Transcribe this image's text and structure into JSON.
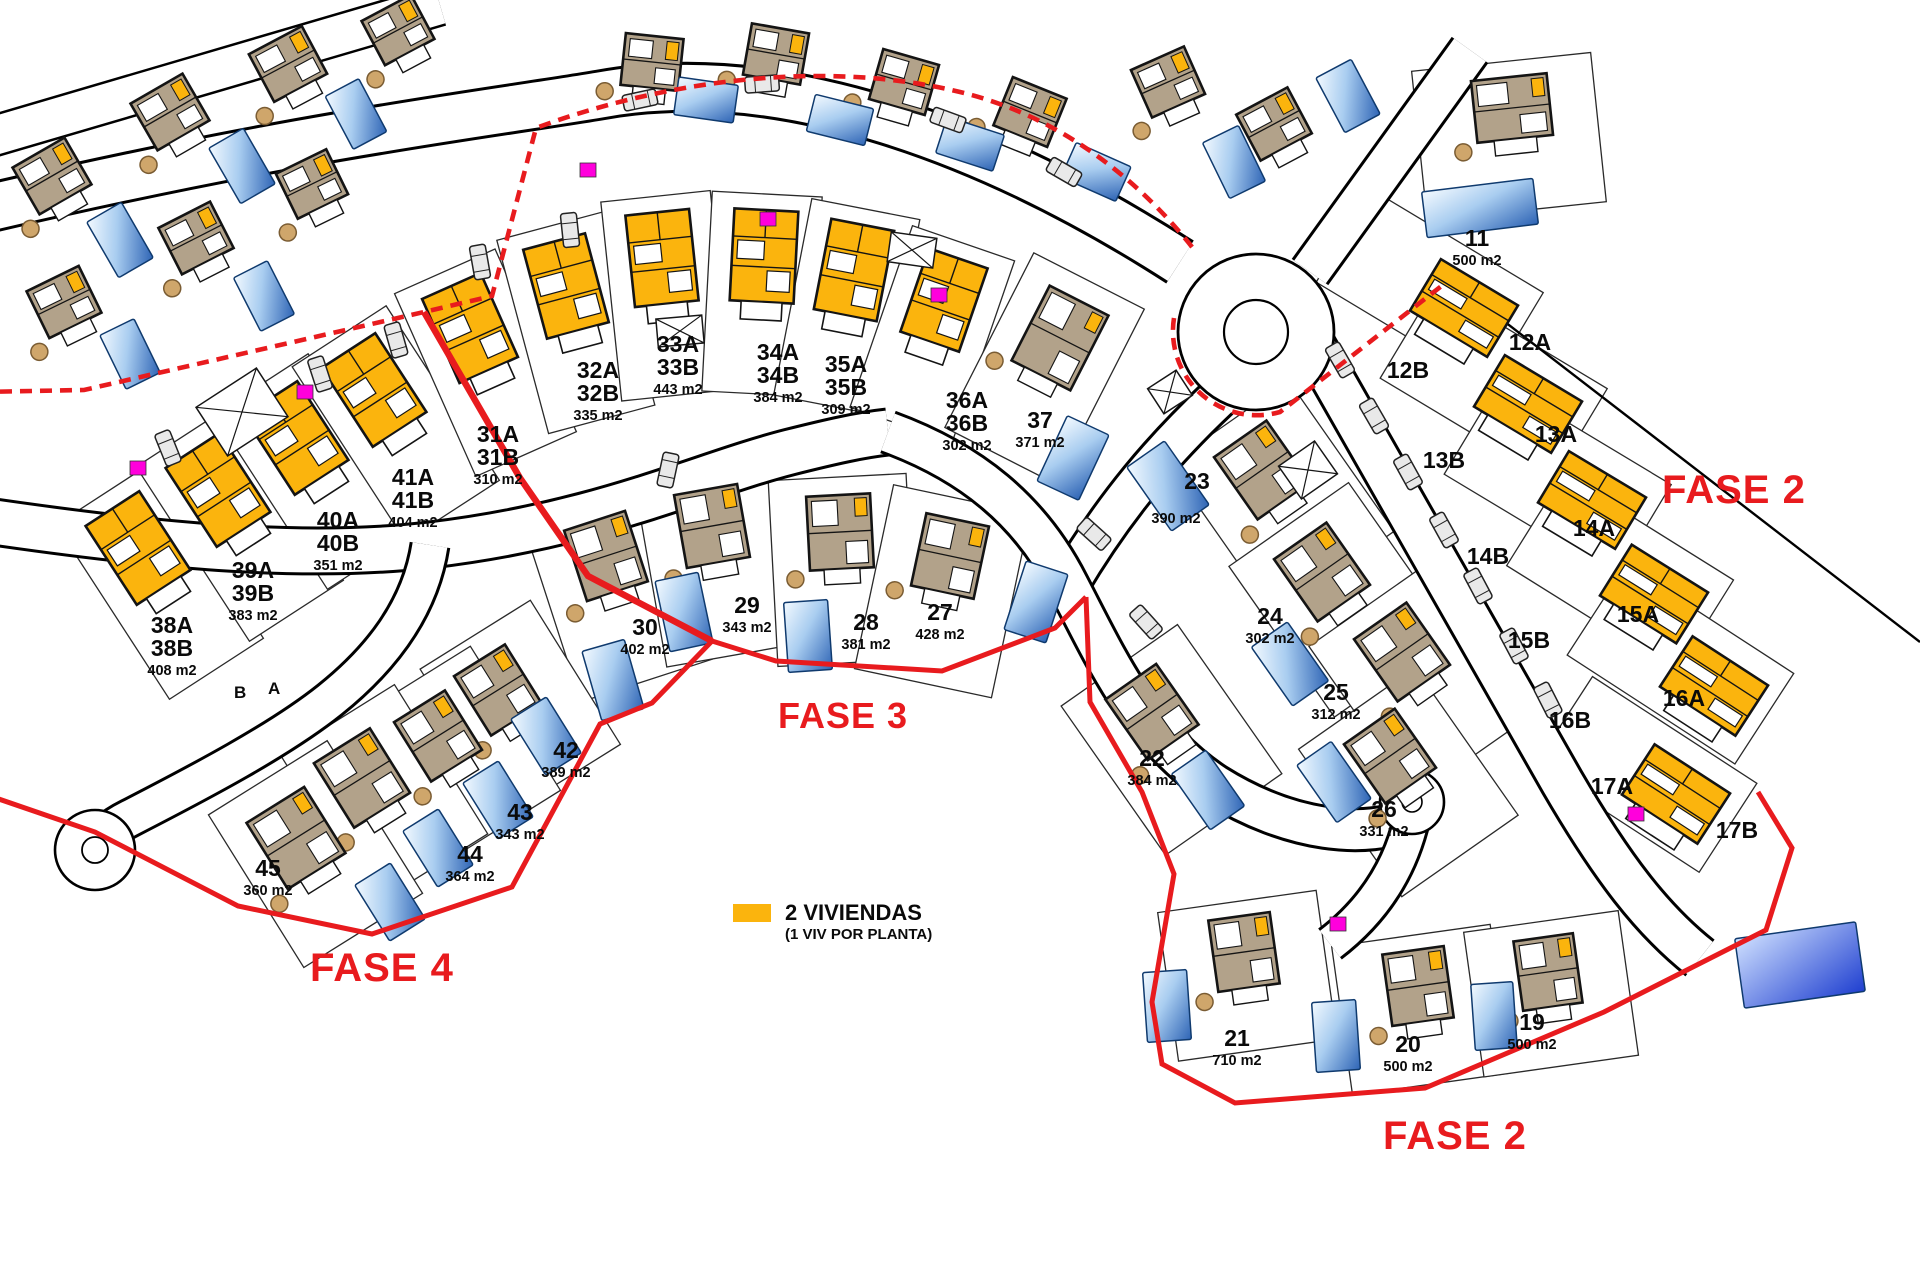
{
  "colors": {
    "duplex": "#FBB40D",
    "villa": "#B2A28A",
    "outline": "#141414",
    "parcel_line": "#2a2a2a",
    "pool_edge": "#0F3A6E",
    "red": "#E81B1E",
    "magenta": "#FF00DC",
    "car": "#E9E9E9",
    "tree": "#CFA66B"
  },
  "legend": {
    "swatch_color": "#FBB40D",
    "line1": "2 VIVIENDAS",
    "line2": "(1 VIV POR PLANTA)"
  },
  "phase_labels": [
    {
      "text": "FASE 2",
      "x": 1662,
      "y": 470,
      "size": 40
    },
    {
      "text": "FASE 3",
      "x": 778,
      "y": 698,
      "size": 36
    },
    {
      "text": "FASE 4",
      "x": 310,
      "y": 948,
      "size": 40
    },
    {
      "text": "FASE 2",
      "x": 1383,
      "y": 1116,
      "size": 40
    }
  ],
  "street_letters": [
    {
      "text": "B",
      "x": 234,
      "y": 684
    },
    {
      "text": "A",
      "x": 268,
      "y": 680
    }
  ],
  "plots": [
    {
      "id": "38",
      "type": "duplex",
      "hx": 138,
      "hy": 548,
      "hr": -33,
      "hw": 64,
      "hh": 94,
      "p": [
        112,
        208,
        0,
        40
      ],
      "pool": null,
      "labels": [
        {
          "x": 172,
          "y": 633,
          "num": [
            "38A",
            "38B"
          ],
          "area": "408 m2"
        }
      ]
    },
    {
      "id": "39",
      "type": "duplex",
      "hx": 218,
      "hy": 490,
      "hr": -33,
      "hw": 64,
      "hh": 94,
      "p": [
        112,
        208,
        0,
        40
      ],
      "pool": null,
      "labels": [
        {
          "x": 253,
          "y": 578,
          "num": [
            "39A",
            "39B"
          ],
          "area": "383 m2"
        }
      ]
    },
    {
      "id": "40",
      "type": "duplex",
      "hx": 296,
      "hy": 438,
      "hr": -33,
      "hw": 64,
      "hh": 94,
      "p": [
        112,
        208,
        0,
        40
      ],
      "pool": null,
      "labels": [
        {
          "x": 338,
          "y": 528,
          "num": [
            "40A",
            "40B"
          ],
          "area": "351 m2"
        }
      ]
    },
    {
      "id": "41",
      "type": "duplex",
      "hx": 374,
      "hy": 390,
      "hr": -33,
      "hw": 64,
      "hh": 94,
      "p": [
        112,
        208,
        0,
        40
      ],
      "pool": null,
      "labels": [
        {
          "x": 413,
          "y": 485,
          "num": [
            "41A",
            "41B"
          ],
          "area": "404 m2"
        }
      ]
    },
    {
      "id": "31",
      "type": "duplex",
      "hx": 470,
      "hy": 328,
      "hr": -24,
      "hw": 64,
      "hh": 92,
      "p": [
        110,
        200,
        0,
        38
      ],
      "pool": null,
      "labels": [
        {
          "x": 498,
          "y": 442,
          "num": [
            "31A",
            "31B"
          ],
          "area": "310 m2"
        }
      ]
    },
    {
      "id": "32",
      "type": "duplex",
      "hx": 566,
      "hy": 286,
      "hr": -15,
      "hw": 64,
      "hh": 92,
      "p": [
        110,
        200,
        0,
        38
      ],
      "pool": null,
      "labels": [
        {
          "x": 598,
          "y": 378,
          "num": [
            "32A",
            "32B"
          ],
          "area": "335 m2"
        }
      ]
    },
    {
      "id": "33",
      "type": "duplex",
      "hx": 662,
      "hy": 258,
      "hr": -6,
      "hw": 64,
      "hh": 92,
      "p": [
        110,
        200,
        0,
        38
      ],
      "pool": null,
      "labels": [
        {
          "x": 678,
          "y": 352,
          "num": [
            "33A",
            "33B"
          ],
          "area": "443 m2"
        }
      ]
    },
    {
      "id": "34",
      "type": "duplex",
      "hx": 764,
      "hy": 256,
      "hr": 3,
      "hw": 64,
      "hh": 92,
      "p": [
        110,
        200,
        0,
        38
      ],
      "pool": null,
      "labels": [
        {
          "x": 778,
          "y": 360,
          "num": [
            "34A",
            "34B"
          ],
          "area": "384 m2"
        }
      ]
    },
    {
      "id": "35",
      "type": "duplex",
      "hx": 854,
      "hy": 270,
      "hr": 11,
      "hw": 64,
      "hh": 92,
      "p": [
        110,
        200,
        0,
        38
      ],
      "pool": null,
      "labels": [
        {
          "x": 846,
          "y": 372,
          "num": [
            "35A",
            "35B"
          ],
          "area": "309 m2"
        }
      ]
    },
    {
      "id": "36",
      "type": "duplex",
      "hx": 944,
      "hy": 300,
      "hr": 19,
      "hw": 62,
      "hh": 88,
      "p": [
        108,
        192,
        0,
        36
      ],
      "pool": null,
      "labels": [
        {
          "x": 967,
          "y": 408,
          "num": [
            "36A",
            "36B"
          ],
          "area": "302 m2"
        }
      ]
    },
    {
      "id": "37",
      "type": "villa",
      "hx": 1060,
      "hy": 338,
      "hr": 27,
      "hw": 66,
      "hh": 84,
      "p": [
        124,
        196,
        0,
        34
      ],
      "pool": [
        1073,
        458,
        25,
        46,
        72
      ],
      "labels": [
        {
          "x": 1040,
          "y": 428,
          "num": [
            "37"
          ],
          "area": "371 m2"
        }
      ]
    },
    {
      "id": "30",
      "type": "villa",
      "hx": 606,
      "hy": 556,
      "hr": -18,
      "hw": 64,
      "hh": 74,
      "p": [
        138,
        186,
        0,
        38
      ],
      "pool": [
        613,
        680,
        -16,
        44,
        72
      ],
      "labels": [
        {
          "x": 645,
          "y": 635,
          "num": [
            "30"
          ],
          "area": "402 m2"
        }
      ]
    },
    {
      "id": "29",
      "type": "villa",
      "hx": 712,
      "hy": 526,
      "hr": -10,
      "hw": 64,
      "hh": 74,
      "p": [
        138,
        186,
        0,
        38
      ],
      "pool": [
        684,
        612,
        -12,
        44,
        72
      ],
      "labels": [
        {
          "x": 747,
          "y": 613,
          "num": [
            "29"
          ],
          "area": "343 m2"
        }
      ]
    },
    {
      "id": "28",
      "type": "villa",
      "hx": 840,
      "hy": 532,
      "hr": -3,
      "hw": 64,
      "hh": 74,
      "p": [
        138,
        186,
        0,
        38
      ],
      "pool": [
        808,
        636,
        -4,
        44,
        70
      ],
      "labels": [
        {
          "x": 866,
          "y": 630,
          "num": [
            "28"
          ],
          "area": "381 m2"
        }
      ]
    },
    {
      "id": "27",
      "type": "villa",
      "hx": 950,
      "hy": 556,
      "hr": 12,
      "hw": 64,
      "hh": 74,
      "p": [
        140,
        188,
        0,
        36
      ],
      "pool": [
        1036,
        602,
        18,
        44,
        72
      ],
      "labels": [
        {
          "x": 940,
          "y": 620,
          "num": [
            "27"
          ],
          "area": "428 m2"
        }
      ]
    },
    {
      "id": "42",
      "type": "villa",
      "hx": 498,
      "hy": 690,
      "hr": -32,
      "hw": 60,
      "hh": 70,
      "p": [
        130,
        170,
        10,
        26
      ],
      "pool": [
        546,
        736,
        -32,
        42,
        66
      ],
      "labels": [
        {
          "x": 566,
          "y": 758,
          "num": [
            "42"
          ],
          "area": "389 m2"
        }
      ]
    },
    {
      "id": "43",
      "type": "villa",
      "hx": 438,
      "hy": 736,
      "hr": -32,
      "hw": 60,
      "hh": 70,
      "p": [
        130,
        170,
        10,
        26
      ],
      "pool": [
        498,
        800,
        -32,
        42,
        66
      ],
      "labels": [
        {
          "x": 520,
          "y": 820,
          "num": [
            "43"
          ],
          "area": "343 m2"
        }
      ]
    },
    {
      "id": "44",
      "type": "villa",
      "hx": 362,
      "hy": 778,
      "hr": -32,
      "hw": 66,
      "hh": 76,
      "p": [
        134,
        176,
        10,
        26
      ],
      "pool": [
        438,
        848,
        -32,
        42,
        66
      ],
      "labels": [
        {
          "x": 470,
          "y": 862,
          "num": [
            "44"
          ],
          "area": "364 m2"
        }
      ]
    },
    {
      "id": "45",
      "type": "villa",
      "hx": 296,
      "hy": 838,
      "hr": -32,
      "hw": 68,
      "hh": 78,
      "p": [
        140,
        180,
        8,
        24
      ],
      "pool": [
        390,
        902,
        -32,
        42,
        66
      ],
      "labels": [
        {
          "x": 268,
          "y": 876,
          "num": [
            "45"
          ],
          "area": "360 m2"
        }
      ]
    },
    {
      "id": "23",
      "type": "villa",
      "hx": 1262,
      "hy": 470,
      "hr": -35,
      "hw": 64,
      "hh": 76,
      "p": [
        146,
        184,
        0,
        34
      ],
      "pool": [
        1168,
        486,
        -35,
        46,
        78
      ],
      "labels": [
        {
          "x": 1197,
          "y": 489,
          "num": [
            "23"
          ]
        },
        {
          "x": 1176,
          "y": 523,
          "num": [],
          "area": "390 m2"
        }
      ]
    },
    {
      "id": "24",
      "type": "villa",
      "hx": 1322,
      "hy": 572,
      "hr": -35,
      "hw": 64,
      "hh": 76,
      "p": [
        146,
        184,
        0,
        34
      ],
      "pool": [
        1290,
        664,
        -35,
        44,
        72
      ],
      "labels": [
        {
          "x": 1270,
          "y": 624,
          "num": [
            "24"
          ],
          "area": "302 m2"
        }
      ]
    },
    {
      "id": "25",
      "type": "villa",
      "hx": 1402,
      "hy": 652,
      "hr": -35,
      "hw": 64,
      "hh": 76,
      "p": [
        146,
        184,
        0,
        34
      ],
      "pool": null,
      "labels": [
        {
          "x": 1336,
          "y": 700,
          "num": [
            "25"
          ],
          "area": "312 m2"
        }
      ]
    },
    {
      "id": "26",
      "type": "villa",
      "hx": 1390,
      "hy": 756,
      "hr": -35,
      "hw": 62,
      "hh": 72,
      "p": [
        142,
        180,
        0,
        32
      ],
      "pool": [
        1334,
        782,
        -35,
        42,
        70
      ],
      "labels": [
        {
          "x": 1384,
          "y": 817,
          "num": [
            "26"
          ],
          "area": "331 m2"
        }
      ]
    },
    {
      "id": "22",
      "type": "villa",
      "hx": 1152,
      "hy": 712,
      "hr": -35,
      "hw": 62,
      "hh": 74,
      "p": [
        142,
        182,
        0,
        34
      ],
      "pool": [
        1208,
        790,
        -35,
        42,
        68
      ],
      "labels": [
        {
          "x": 1152,
          "y": 766,
          "num": [
            "22"
          ],
          "area": "384 m2"
        }
      ]
    },
    {
      "id": "21",
      "type": "villa",
      "hx": 1244,
      "hy": 952,
      "hr": -8,
      "hw": 62,
      "hh": 72,
      "p": [
        160,
        150,
        0,
        24
      ],
      "pool": [
        1167,
        1006,
        -4,
        44,
        70
      ],
      "labels": [
        {
          "x": 1237,
          "y": 1046,
          "num": [
            "21"
          ],
          "area": "710 m2"
        }
      ]
    },
    {
      "id": "20",
      "type": "villa",
      "hx": 1418,
      "hy": 986,
      "hr": -8,
      "hw": 62,
      "hh": 72,
      "p": [
        160,
        150,
        0,
        24
      ],
      "pool": [
        1336,
        1036,
        -4,
        44,
        70
      ],
      "labels": [
        {
          "x": 1408,
          "y": 1052,
          "num": [
            "20"
          ],
          "area": "500 m2"
        }
      ]
    },
    {
      "id": "19",
      "type": "villa",
      "hx": 1548,
      "hy": 972,
      "hr": -8,
      "hw": 60,
      "hh": 70,
      "p": [
        156,
        146,
        0,
        22
      ],
      "pool": [
        1494,
        1016,
        -4,
        42,
        66
      ],
      "labels": [
        {
          "x": 1532,
          "y": 1030,
          "num": [
            "19"
          ],
          "area": "500 m2"
        }
      ]
    },
    {
      "id": "11",
      "type": "villa",
      "hx": 1512,
      "hy": 108,
      "hr": -6,
      "hw": 76,
      "hh": 62,
      "p": [
        180,
        150,
        -6,
        28
      ],
      "pool": [
        1480,
        208,
        -7,
        112,
        46
      ],
      "labels": [
        {
          "x": 1477,
          "y": 246,
          "num": [
            "11"
          ],
          "area": "500 m2"
        }
      ]
    },
    {
      "id": "12",
      "type": "duplex",
      "hx": 1464,
      "hy": 308,
      "hr": 31,
      "hw": 90,
      "hh": 60,
      "p": [
        200,
        108,
        -40,
        0
      ],
      "pool": null,
      "labels": [
        {
          "x": 1408,
          "y": 378,
          "num": [
            "12B"
          ]
        },
        {
          "x": 1530,
          "y": 350,
          "num": [
            "12A"
          ]
        }
      ]
    },
    {
      "id": "13",
      "type": "duplex",
      "hx": 1528,
      "hy": 404,
      "hr": 31,
      "hw": 90,
      "hh": 60,
      "p": [
        200,
        108,
        -40,
        0
      ],
      "pool": null,
      "labels": [
        {
          "x": 1444,
          "y": 468,
          "num": [
            "13B"
          ]
        },
        {
          "x": 1556,
          "y": 442,
          "num": [
            "13A"
          ]
        }
      ]
    },
    {
      "id": "14",
      "type": "duplex",
      "hx": 1592,
      "hy": 500,
      "hr": 31,
      "hw": 90,
      "hh": 60,
      "p": [
        200,
        108,
        -40,
        0
      ],
      "pool": null,
      "labels": [
        {
          "x": 1488,
          "y": 564,
          "num": [
            "14B"
          ]
        },
        {
          "x": 1594,
          "y": 536,
          "num": [
            "14A"
          ]
        }
      ]
    },
    {
      "id": "15",
      "type": "duplex",
      "hx": 1654,
      "hy": 594,
      "hr": 32,
      "hw": 90,
      "hh": 60,
      "p": [
        200,
        108,
        -40,
        0
      ],
      "pool": null,
      "labels": [
        {
          "x": 1529,
          "y": 648,
          "num": [
            "15B"
          ]
        },
        {
          "x": 1638,
          "y": 622,
          "num": [
            "15A"
          ]
        }
      ]
    },
    {
      "id": "16",
      "type": "duplex",
      "hx": 1714,
      "hy": 686,
      "hr": 33,
      "hw": 90,
      "hh": 60,
      "p": [
        200,
        108,
        -40,
        0
      ],
      "pool": null,
      "labels": [
        {
          "x": 1570,
          "y": 728,
          "num": [
            "16B"
          ]
        },
        {
          "x": 1684,
          "y": 706,
          "num": [
            "16A"
          ]
        }
      ]
    },
    {
      "id": "17",
      "type": "duplex",
      "hx": 1676,
      "hy": 794,
      "hr": 33,
      "hw": 90,
      "hh": 60,
      "p": [
        196,
        106,
        -36,
        0
      ],
      "pool": null,
      "labels": [
        {
          "x": 1612,
          "y": 794,
          "num": [
            "17A"
          ]
        },
        {
          "x": 1737,
          "y": 838,
          "num": [
            "17B"
          ]
        }
      ]
    }
  ],
  "context_houses": [
    [
      52,
      176,
      -30,
      60,
      54
    ],
    [
      170,
      112,
      -30,
      60,
      54
    ],
    [
      288,
      64,
      -28,
      60,
      54
    ],
    [
      398,
      30,
      -28,
      56,
      50
    ],
    [
      64,
      302,
      -26,
      58,
      52
    ],
    [
      196,
      238,
      -27,
      58,
      52
    ],
    [
      312,
      184,
      -26,
      56,
      50
    ],
    [
      652,
      62,
      6,
      58,
      52
    ],
    [
      776,
      54,
      10,
      58,
      52
    ],
    [
      904,
      82,
      16,
      58,
      52
    ],
    [
      1030,
      112,
      22,
      58,
      52
    ],
    [
      1168,
      82,
      -24,
      58,
      52
    ],
    [
      1274,
      124,
      -28,
      58,
      52
    ]
  ],
  "context_pools": [
    [
      120,
      240,
      -30,
      40,
      64
    ],
    [
      242,
      166,
      -30,
      40,
      64
    ],
    [
      356,
      114,
      -28,
      38,
      60
    ],
    [
      130,
      354,
      -26,
      38,
      60
    ],
    [
      264,
      296,
      -27,
      38,
      60
    ],
    [
      706,
      100,
      8,
      60,
      38
    ],
    [
      840,
      120,
      14,
      60,
      38
    ],
    [
      970,
      144,
      18,
      60,
      38
    ],
    [
      1096,
      172,
      24,
      60,
      38
    ],
    [
      1234,
      162,
      -26,
      40,
      62
    ],
    [
      1348,
      96,
      -28,
      40,
      62
    ]
  ],
  "big_pool": [
    1800,
    965,
    -8,
    122,
    70
  ],
  "cars": [
    [
      640,
      100,
      -12
    ],
    [
      762,
      84,
      -4
    ],
    [
      948,
      120,
      20
    ],
    [
      1064,
      172,
      30
    ],
    [
      1340,
      360,
      60
    ],
    [
      1374,
      416,
      60
    ],
    [
      1408,
      472,
      61
    ],
    [
      1444,
      530,
      61
    ],
    [
      1478,
      586,
      62
    ],
    [
      1514,
      646,
      62
    ],
    [
      1548,
      700,
      63
    ],
    [
      168,
      448,
      68
    ],
    [
      244,
      410,
      70
    ],
    [
      320,
      374,
      72
    ],
    [
      396,
      340,
      74
    ],
    [
      480,
      262,
      80
    ],
    [
      570,
      230,
      84
    ],
    [
      1094,
      534,
      42
    ],
    [
      1146,
      622,
      48
    ],
    [
      668,
      470,
      -78
    ]
  ],
  "x_markers": [
    [
      242,
      412,
      72,
      58,
      -33
    ],
    [
      680,
      331,
      46,
      28,
      -5
    ],
    [
      912,
      250,
      46,
      30,
      8
    ],
    [
      1170,
      392,
      34,
      30,
      -33
    ],
    [
      1308,
      470,
      44,
      40,
      -35
    ]
  ],
  "magenta_markers": [
    [
      138,
      468
    ],
    [
      305,
      392
    ],
    [
      588,
      170
    ],
    [
      768,
      219
    ],
    [
      939,
      295
    ],
    [
      1338,
      924
    ],
    [
      1636,
      814
    ]
  ]
}
